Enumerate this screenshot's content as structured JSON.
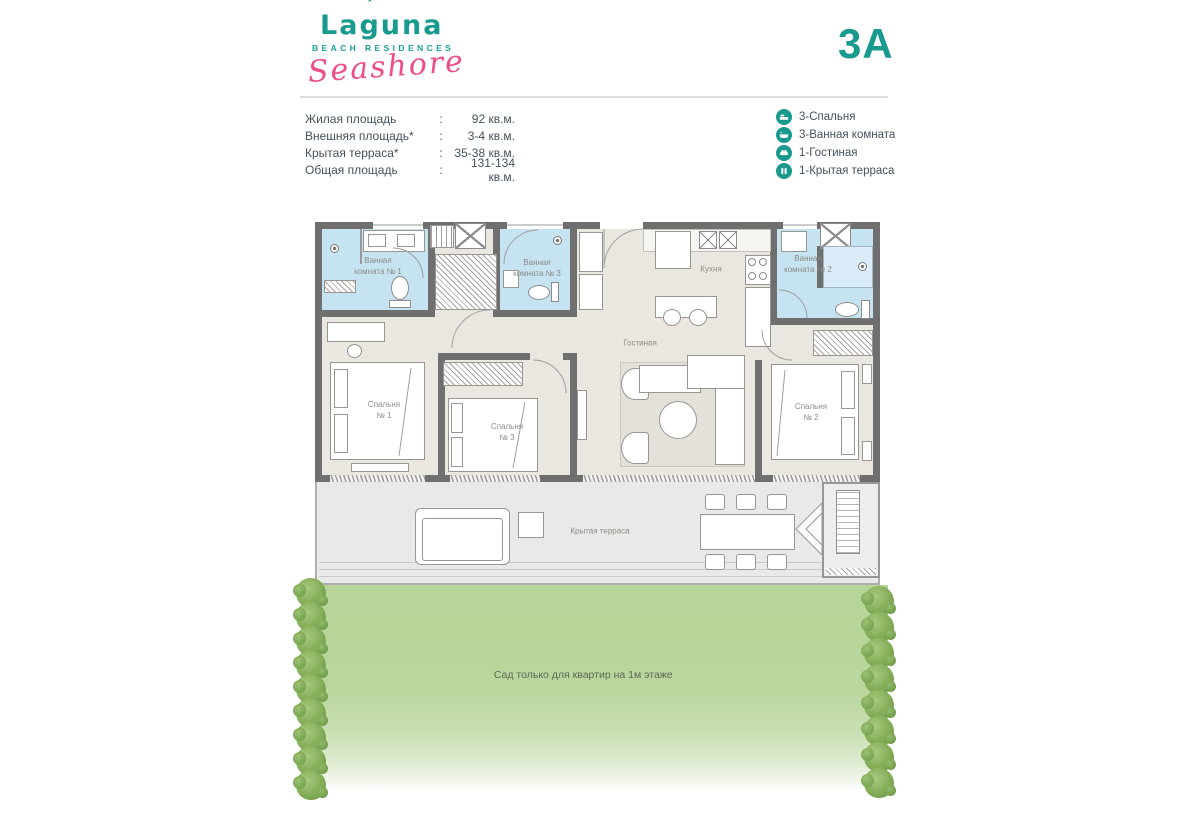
{
  "header": {
    "brand_prefix": "La",
    "brand_g": "g",
    "brand_suffix": "una",
    "brand_tagline": "BEACH RESIDENCES",
    "brand_script": "Seashore",
    "unit_code": "3A"
  },
  "specs_colon": ":",
  "specs": [
    {
      "label": "Жилая площадь",
      "value": "92 кв.м."
    },
    {
      "label": "Внешняя площадь*",
      "value": "3-4 кв.м."
    },
    {
      "label": "Крытая терраса*",
      "value": "35-38 кв.м."
    },
    {
      "label": "Общая площадь",
      "value": "131-134 кв.м."
    }
  ],
  "legend": [
    {
      "icon": "bed-icon",
      "label": "3-Спальня"
    },
    {
      "icon": "bathtub-icon",
      "label": "3-Ванная комната"
    },
    {
      "icon": "sofa-icon",
      "label": "1-Гостиная"
    },
    {
      "icon": "terrace-icon",
      "label": "1-Крытая терраса"
    }
  ],
  "plan": {
    "rooms": {
      "bathroom1": "Ванная\nкомната № 1",
      "bathroom3": "Ванная\nкомната № 3",
      "bathroom2": "Ванная\nкомната № 2",
      "kitchen": "Кухня",
      "living": "Гостиная",
      "bedroom1": "Спальня\n№ 1",
      "bedroom3": "Спальня\n№ 3",
      "bedroom2": "Спальня\n№ 2",
      "terrace": "Крытая терраса"
    }
  },
  "garden": {
    "note": "Сад только для квартир на 1м этаже",
    "tree_count_left": 9,
    "tree_count_right": 8
  },
  "colors": {
    "teal": "#189a8f",
    "pink": "#ee4d8b",
    "bathroom_blue": "#c6e3f2",
    "garden_green": "#b7d499"
  }
}
